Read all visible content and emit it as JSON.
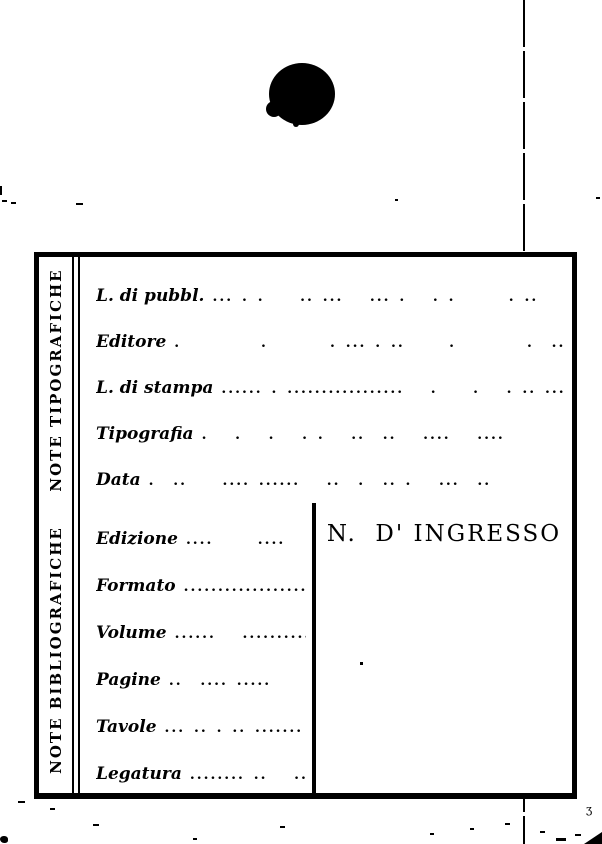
{
  "page": {
    "background": "#ffffff",
    "ink_color": "#000000",
    "kind": "scanned library accession card (blank form, Italian)"
  },
  "card": {
    "sections": [
      {
        "side_label": "NOTE TIPOGRAFICHE",
        "rows": [
          {
            "label": "L. di pubbl.",
            "dots": "... . .    .. ...   ... .   . .      . ..   ....."
          },
          {
            "label": "Editore",
            "dots": ".         .       . ... . ..     .        .  ...."
          },
          {
            "label": "L. di stampa",
            "dots": "...... . .................   .    .   . .. ...."
          },
          {
            "label": "Tipografia",
            "dots": ".   .   .   . .   ..  ..   ....   ...."
          },
          {
            "label": "Data",
            "dots": ".  ..    .... ......   ..  .  .. .   ...  .."
          }
        ]
      },
      {
        "side_label": "NOTE BIBLIOGRAFICHE",
        "rows": [
          {
            "label": "Edizione",
            "dots": "....     ....    . ."
          },
          {
            "label": "Formato",
            "dots": "....................."
          },
          {
            "label": "Volume",
            "dots": "......   .............."
          },
          {
            "label": "Pagine",
            "dots": "..  .... .....    ..."
          },
          {
            "label": "Tavole",
            "dots": "... .. . .. ......."
          },
          {
            "label": "Legatura",
            "dots": "........ ..   .."
          }
        ],
        "ingress_label": "N.  D' INGRESSO"
      }
    ]
  }
}
